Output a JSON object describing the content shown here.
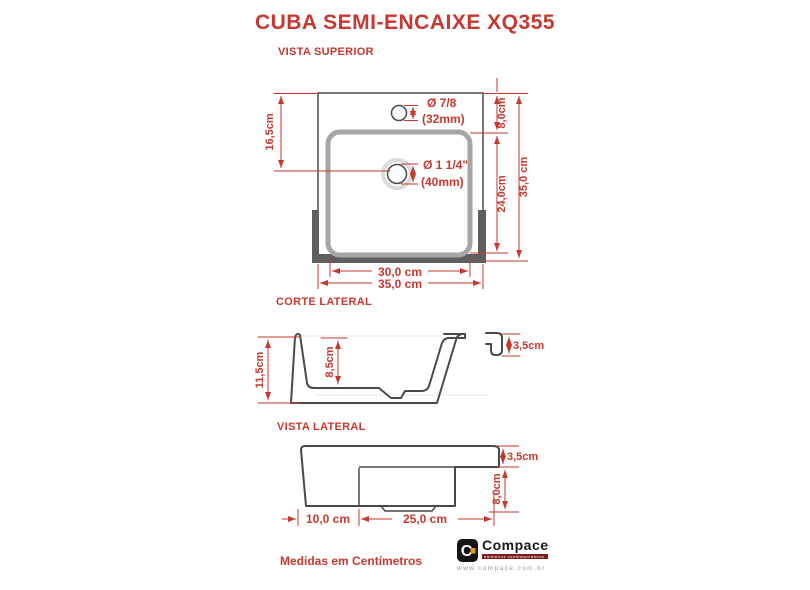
{
  "title": "CUBA SEMI-ENCAIXE XQ355",
  "views": {
    "top": {
      "label": "VISTA SUPERIOR",
      "dims": {
        "height_to_drain": "16,5cm",
        "faucet_hole_diameter": "Ø 7/8",
        "faucet_hole_mm": "(32mm)",
        "drain_diameter": "Ø 1 1/4\"",
        "drain_mm": "(40mm)",
        "top_to_basin": "8,0cm",
        "basin_depth": "24,0cm",
        "overall_depth": "35,0 cm",
        "basin_width": "30,0 cm",
        "overall_width": "35,0 cm"
      }
    },
    "section": {
      "label": "CORTE LATERAL",
      "dims": {
        "overall_height": "11,5cm",
        "bowl_depth": "8,5cm",
        "rim_height": "3,5cm"
      }
    },
    "side": {
      "label": "VISTA LATERAL",
      "dims": {
        "rim_height": "3,5cm",
        "body_height": "8,0cm",
        "back_offset": "10,0 cm",
        "body_length": "25,0 cm"
      }
    }
  },
  "footer": {
    "note": "Medidas em Centímetros"
  },
  "logo": {
    "brand": "Compace",
    "brand_initial": "C",
    "tagline": "banheiros contemporâneos",
    "website": "www.compace.com.br"
  },
  "colors": {
    "accent_red": "#c53931",
    "outline": "#4a4a4a",
    "basin_gray": "#a6a6a6",
    "bracket_gray": "#5f5f5f",
    "halo_gray": "#dcdcdc",
    "logo_black": "#141414",
    "logo_orange": "#e09a26",
    "tagline_maroon": "#7a1c1c"
  }
}
